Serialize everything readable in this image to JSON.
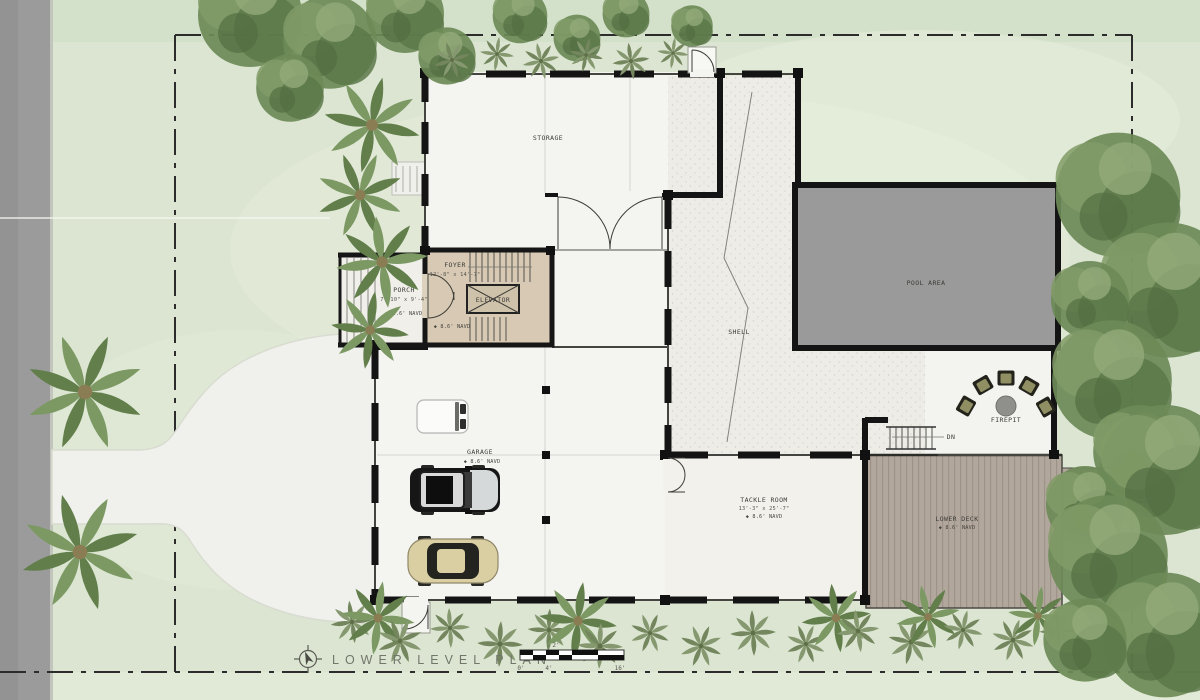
{
  "plan": {
    "title": "LOWER LEVEL PLAN",
    "scale": {
      "top_tick": "2'",
      "tick0": "0'",
      "tick1": "4'",
      "tick2": "16'"
    }
  },
  "labels": {
    "storage": "STORAGE",
    "foyer": "FOYER",
    "foyer_dims": "12'-8\" x 14'-7\"",
    "foyer_elev": "◆ 8.6' NAVD",
    "elevator": "ELEVATOR",
    "porch": "PORCH",
    "porch_dims": "7'-10\" x 9'-4\"",
    "porch_elev": "◆ 8.6' NAVD",
    "shell": "SHELL",
    "pool": "POOL AREA",
    "garage": "GARAGE",
    "garage_elev": "◆ 8.6' NAVD",
    "tackle": "TACKLE ROOM",
    "tackle_dims": "13'-3\" x 25'-7\"",
    "tackle_elev": "◆ 8.6' NAVD",
    "firepit": "FIREPIT",
    "deck": "LOWER DECK",
    "deck_elev": "◆ 8.6' NAVD",
    "dn": "DN"
  },
  "colors": {
    "wall": "#161616",
    "lawn": "#dbe5d1",
    "road": "#9b9b9b",
    "floor": "#f4f4f1",
    "shell_floor": "#edece6",
    "foyer_floor": "#d7c9b3",
    "pool": "#9a9a9a",
    "deck": "#b2a79c",
    "driveway": "#f0f1ec"
  }
}
